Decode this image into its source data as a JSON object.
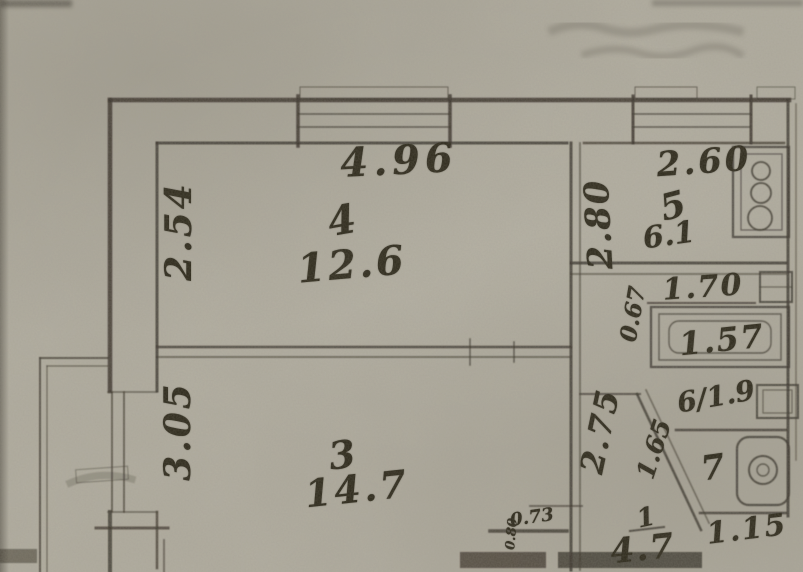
{
  "plan": {
    "rooms": {
      "room4": {
        "number": "4",
        "area": "12.6"
      },
      "room3": {
        "number": "3",
        "area": "14.7"
      },
      "room5": {
        "number": "5",
        "area": "6.1"
      },
      "room6": {
        "number_area": "6/1.9"
      },
      "room7": {
        "number": "7"
      },
      "room1": {
        "number": "1",
        "area": "4.7"
      }
    },
    "dimensions": {
      "top_width": "4.96",
      "room4_height": "2.54",
      "room3_height": "3.05",
      "kitchen_width": "2.60",
      "kitchen_height": "2.80",
      "bath_niche_offset": "0.67",
      "bath_width": "1.70",
      "bathtub_length": "1.57",
      "hall_height": "2.75",
      "corridor_diagonal": "1.65",
      "wc_width": "1.15",
      "hall_door_width": "0.73",
      "hall_door_depth": "0.80"
    },
    "fixtures": {
      "stove": "stove-icon",
      "bathtub": "bathtub-icon",
      "toilet": "toilet-icon",
      "bathroom_sink": "sink-icon",
      "washbasin": "washbasin-icon",
      "window_living": "window-icon",
      "window_kitchen": "window-icon",
      "balcony": "balcony-railing"
    },
    "colors": {
      "paper": "#b3afa2",
      "ink": "#2b2719"
    }
  }
}
